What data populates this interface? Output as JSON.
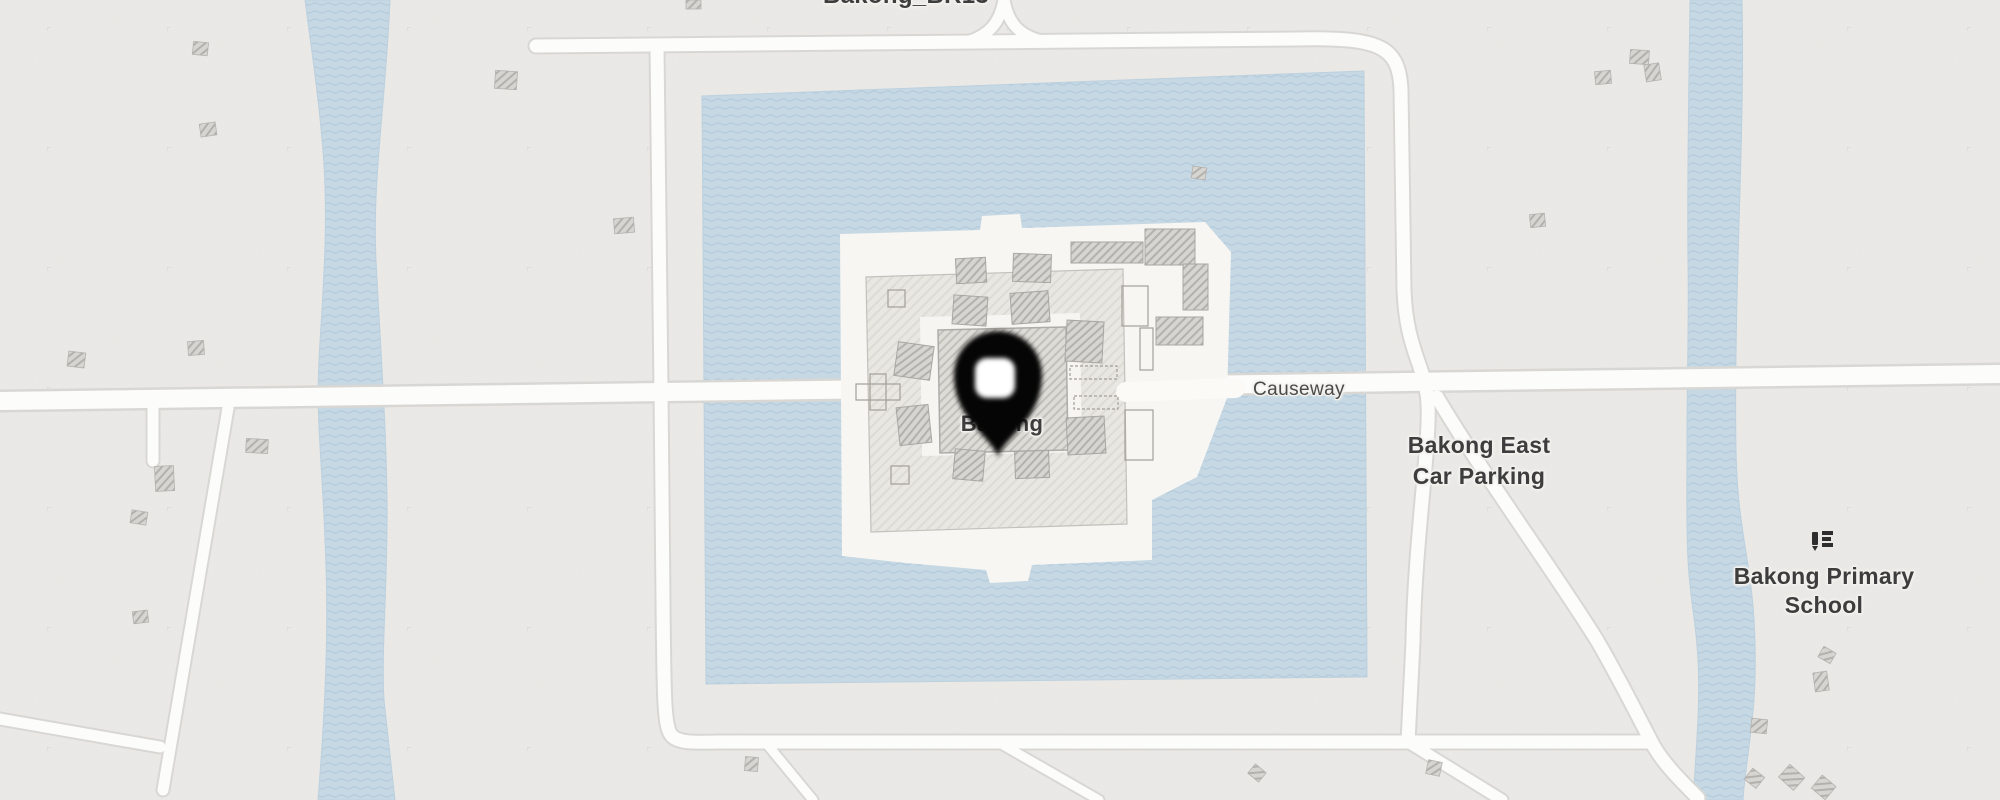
{
  "app": {
    "type": "map-canvas",
    "description": "Map view of Bakong temple with moat, causeway and surrounding area"
  },
  "labels": {
    "waypoint": "Bakong_BR13",
    "temple": "Bakong",
    "road": "Causeway",
    "parking": [
      "Bakong East",
      "Car Parking"
    ],
    "school": [
      "Bakong Primary",
      "School"
    ]
  },
  "marker": {
    "kind": "dropped-pin"
  },
  "icons": {
    "school": "school-icon"
  },
  "colors": {
    "land": "#ebeae7",
    "water": "#c5d8e4",
    "water_wave": "#aac3d5",
    "road_fill": "#fcfcfb",
    "road_casing": "#d8d7d4",
    "island": "#f7f6f2",
    "enclosure": "#e9e7e2",
    "building": "#d7d5d1",
    "pin": "#050505",
    "label_dark": "#3d3d3d",
    "label_road": "#4a4a4a"
  }
}
